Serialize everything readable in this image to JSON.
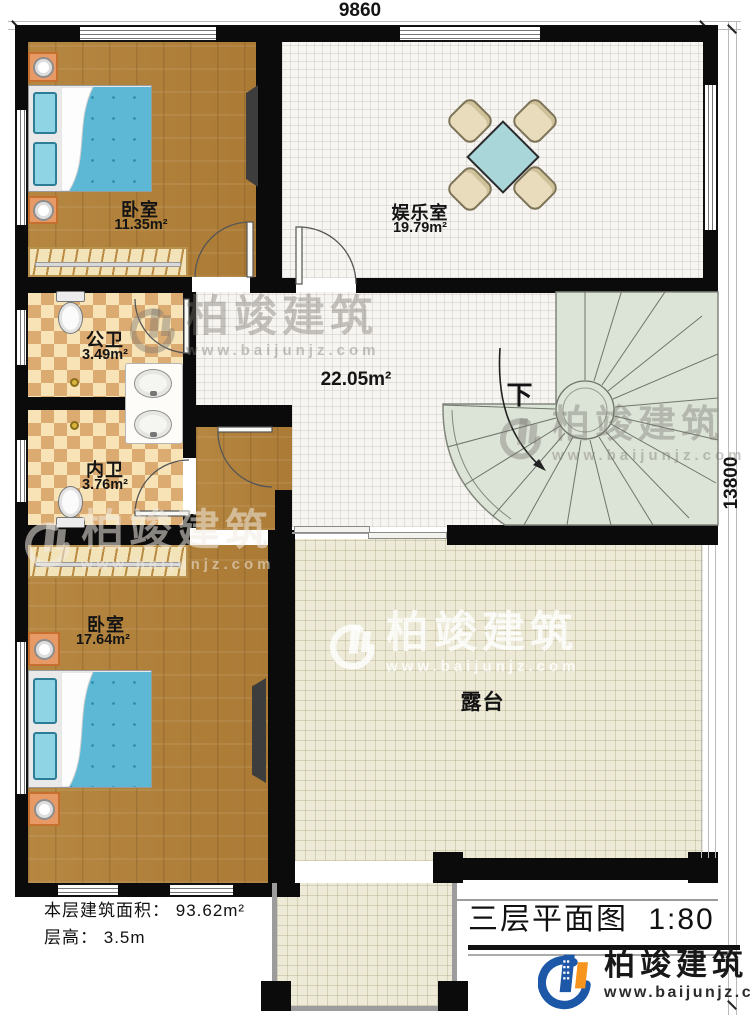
{
  "dimensions": {
    "top": "9860",
    "right": "13800"
  },
  "rooms": {
    "bedroom1": {
      "name": "卧室",
      "area": "11.35m²"
    },
    "entertainment": {
      "name": "娱乐室",
      "area": "19.79m²"
    },
    "public_bath": {
      "name": "公卫",
      "area": "3.49m²"
    },
    "private_bath": {
      "name": "内卫",
      "area": "3.76m²"
    },
    "hall": {
      "area": "22.05m²"
    },
    "bedroom2": {
      "name": "卧室",
      "area": "17.64m²"
    },
    "terrace": {
      "name": "露台"
    }
  },
  "stairs": {
    "direction_label": "下"
  },
  "footer": {
    "floor_area_label": "本层建筑面积：",
    "floor_area_value": "93.62m²",
    "floor_height_label": "层高：",
    "floor_height_value": "3.5m",
    "title": "三层平面图",
    "scale": "1:80"
  },
  "brand": {
    "name": "柏竣建筑",
    "website": "www.baijunjz.com"
  }
}
